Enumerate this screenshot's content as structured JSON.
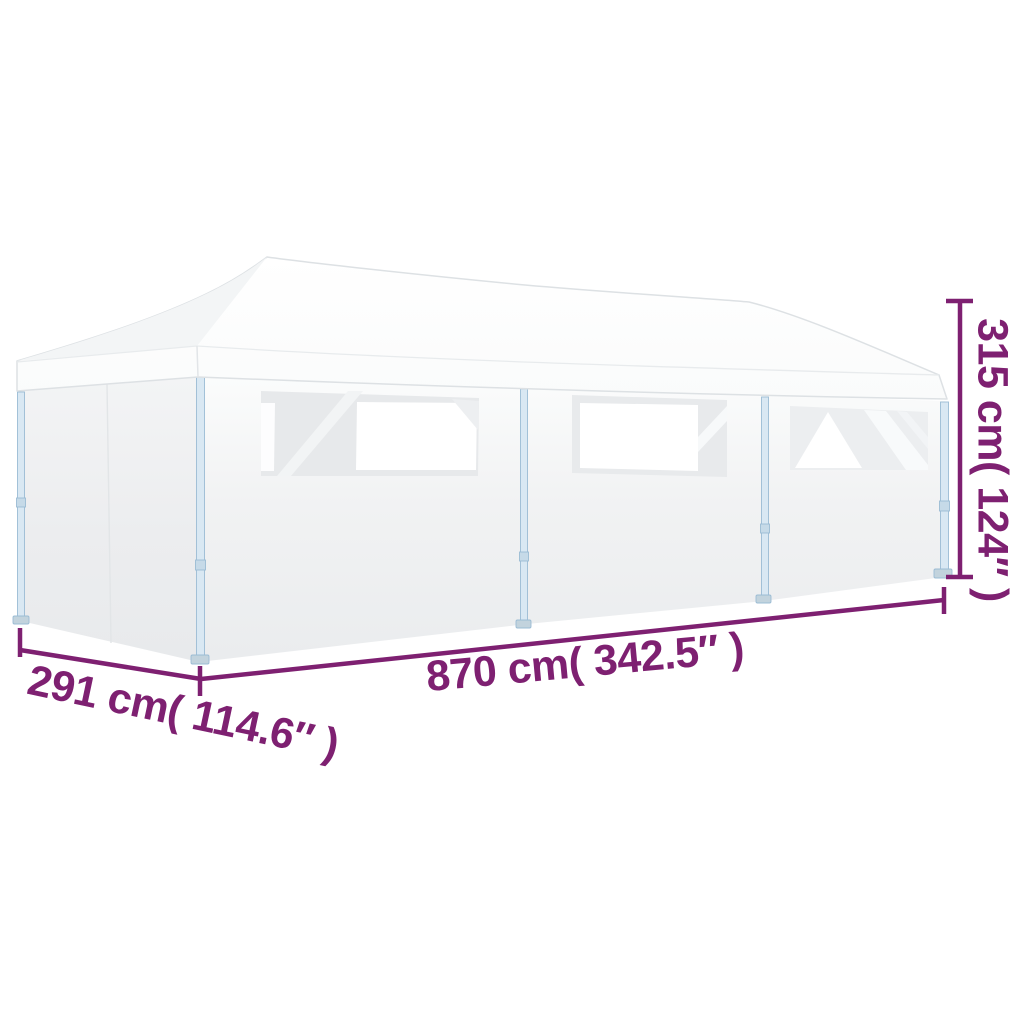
{
  "diagram": {
    "subject": "pop-up gazebo with sidewalls and windows",
    "dimensions": {
      "width_label": "870 cm( 342.5″ )",
      "depth_label": "291 cm( 114.6″ )",
      "height_label": "315 cm( 124″ )"
    },
    "colors": {
      "annotation": "#7e2071",
      "frame": "#a6c5db",
      "fabric": "#ffffff",
      "fabric_shade": "#eaecee"
    }
  }
}
